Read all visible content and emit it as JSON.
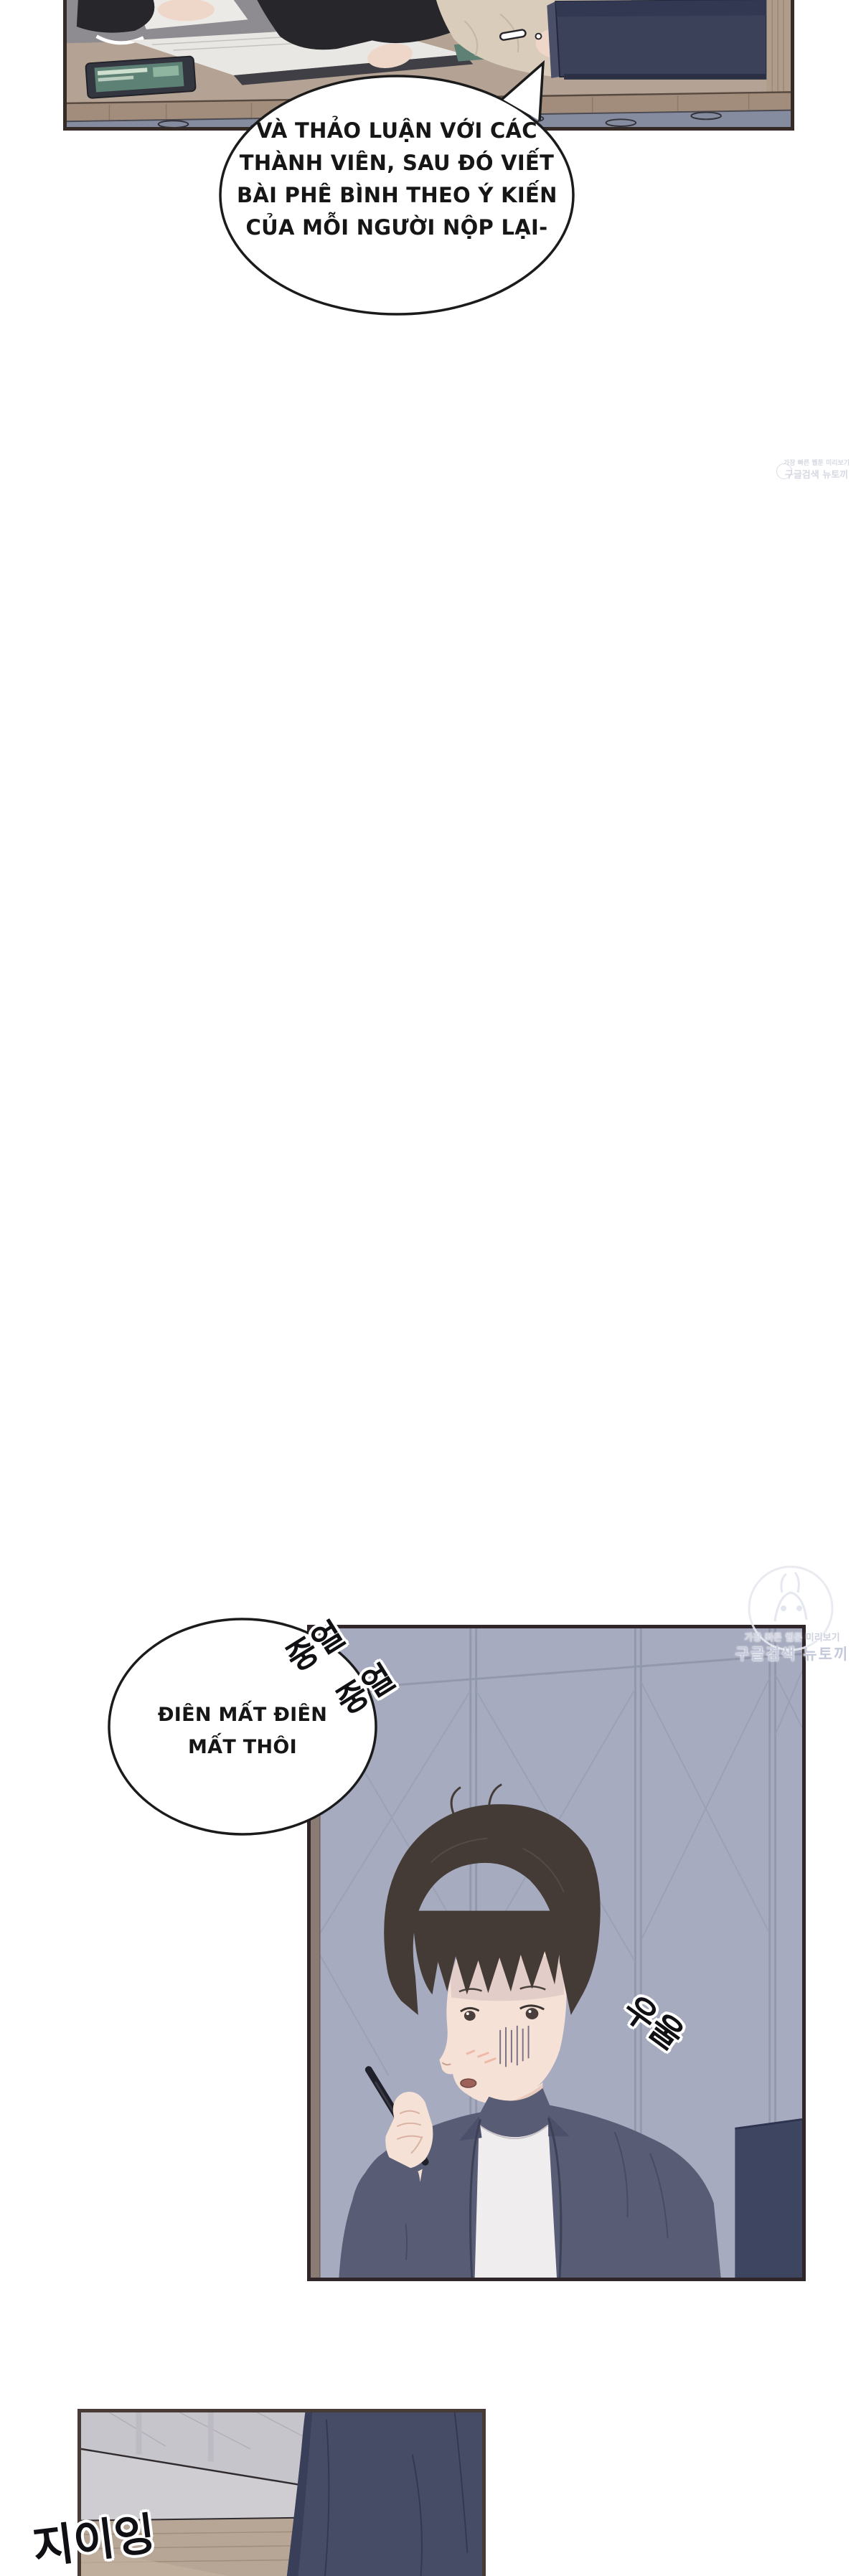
{
  "speech": {
    "bubble1": {
      "lines": [
        "VÀ THẢO LUẬN VỚI CÁC",
        "THÀNH VIÊN, SAU ĐÓ VIẾT",
        "BÀI PHÊ BÌNH THEO Ý KIẾN",
        "CỦA MỖI NGƯỜI NỘP LẠI-"
      ]
    },
    "bubble2": {
      "lines": [
        "ĐIÊN MẤT ĐIÊN",
        "MẤT THÔI"
      ]
    }
  },
  "sfx": {
    "mutter_1": "중얼",
    "mutter_2": "중얼",
    "gloom": "우울",
    "buzz": "지이잉"
  },
  "watermark": {
    "tagline": "가장 빠른 웹툰 미리보기",
    "brand": "구글검색 뉴토끼"
  },
  "colors": {
    "panel_border": "#362c27",
    "top_background": "#8e8b91",
    "desk": "#b4a394",
    "wood_band": "#a28d7c",
    "drawer_front": "#868ca0",
    "laptop": "#3c415a",
    "tablet_screen": "#5d8174",
    "sweater": "#d9ccba",
    "dark_clothes": "#26262b",
    "skin": "#f3dcd0",
    "wall_mid_panel": "#a6abbf",
    "wall_lines": "#9197ac",
    "hair": "#443a36",
    "shirt": "#585c74",
    "tee": "#f0edef",
    "sofa": "#3e4560",
    "bottom_wall": "#c7c5cc",
    "floor_wood": "#b7a595",
    "figure_dark": "#474c66",
    "sfx_ink": "#0f0f14",
    "watermark_gray": "#ced2e0"
  }
}
